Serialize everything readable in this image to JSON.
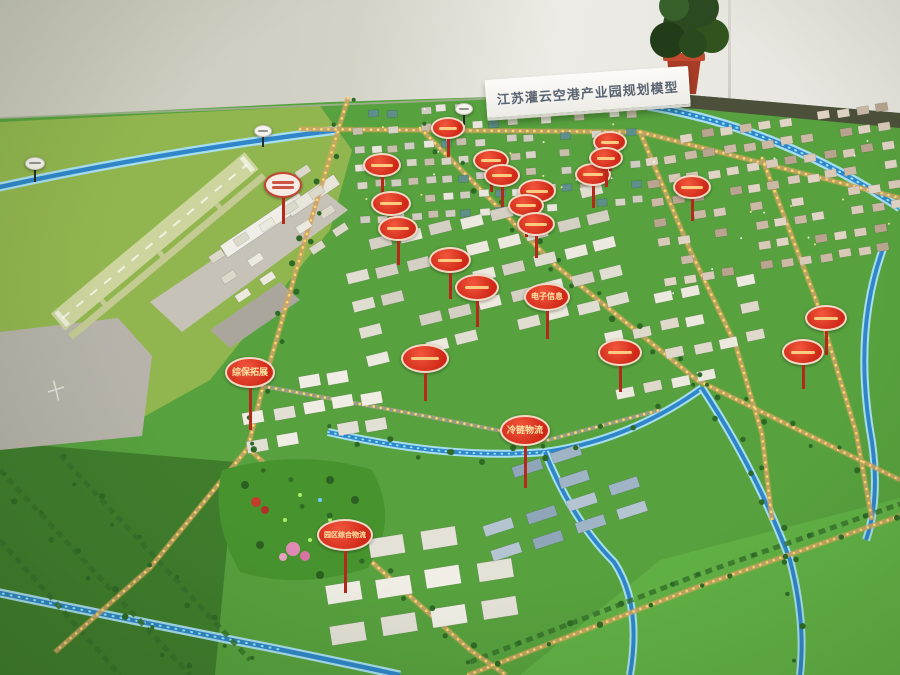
{
  "photo": {
    "title_board": {
      "text": "江苏灌云空港产业园规划模型"
    },
    "colors": {
      "sign_red": "#d02a18",
      "sign_text": "#ffe9a8",
      "road_lights": "#ffd76a",
      "river": "#2f86c8",
      "grass": "#58a13e",
      "wall": "#d9d7cd"
    },
    "signs": [
      {
        "x": 35,
        "y": 162,
        "w": 18,
        "h": 11,
        "pole": 12,
        "style": "white",
        "label": ""
      },
      {
        "x": 263,
        "y": 130,
        "w": 16,
        "h": 10,
        "pole": 10,
        "style": "white",
        "label": ""
      },
      {
        "x": 464,
        "y": 108,
        "w": 16,
        "h": 10,
        "pole": 10,
        "style": "white",
        "label": ""
      },
      {
        "x": 283,
        "y": 183,
        "w": 34,
        "h": 22,
        "pole": 26,
        "style": "light",
        "label": ""
      },
      {
        "x": 448,
        "y": 126,
        "w": 30,
        "h": 18,
        "pole": 18,
        "style": "red",
        "label": ""
      },
      {
        "x": 382,
        "y": 163,
        "w": 34,
        "h": 20,
        "pole": 22,
        "style": "red",
        "label": ""
      },
      {
        "x": 391,
        "y": 201,
        "w": 36,
        "h": 21,
        "pole": 24,
        "style": "red",
        "label": ""
      },
      {
        "x": 398,
        "y": 226,
        "w": 36,
        "h": 21,
        "pole": 24,
        "style": "red",
        "label": ""
      },
      {
        "x": 491,
        "y": 158,
        "w": 32,
        "h": 19,
        "pole": 20,
        "style": "red",
        "label": ""
      },
      {
        "x": 502,
        "y": 173,
        "w": 32,
        "h": 19,
        "pole": 20,
        "style": "red",
        "label": ""
      },
      {
        "x": 537,
        "y": 189,
        "w": 34,
        "h": 20,
        "pole": 22,
        "style": "red",
        "label": ""
      },
      {
        "x": 526,
        "y": 203,
        "w": 32,
        "h": 19,
        "pole": 20,
        "style": "red",
        "label": ""
      },
      {
        "x": 536,
        "y": 222,
        "w": 34,
        "h": 20,
        "pole": 22,
        "style": "red",
        "label": ""
      },
      {
        "x": 593,
        "y": 172,
        "w": 32,
        "h": 19,
        "pole": 22,
        "style": "red",
        "label": ""
      },
      {
        "x": 610,
        "y": 140,
        "w": 30,
        "h": 18,
        "pole": 18,
        "style": "red",
        "label": ""
      },
      {
        "x": 606,
        "y": 156,
        "w": 30,
        "h": 18,
        "pole": 18,
        "style": "red",
        "label": ""
      },
      {
        "x": 692,
        "y": 185,
        "w": 34,
        "h": 20,
        "pole": 22,
        "style": "red",
        "label": ""
      },
      {
        "x": 826,
        "y": 316,
        "w": 38,
        "h": 22,
        "pole": 24,
        "style": "red",
        "label": ""
      },
      {
        "x": 803,
        "y": 350,
        "w": 38,
        "h": 22,
        "pole": 24,
        "style": "red",
        "label": ""
      },
      {
        "x": 450,
        "y": 258,
        "w": 38,
        "h": 22,
        "pole": 26,
        "style": "red",
        "label": ""
      },
      {
        "x": 477,
        "y": 285,
        "w": 40,
        "h": 23,
        "pole": 26,
        "style": "red",
        "label": ""
      },
      {
        "x": 547,
        "y": 295,
        "w": 42,
        "h": 24,
        "pole": 28,
        "style": "red",
        "label": "电子信息"
      },
      {
        "x": 425,
        "y": 356,
        "w": 44,
        "h": 25,
        "pole": 28,
        "style": "red",
        "label": ""
      },
      {
        "x": 620,
        "y": 350,
        "w": 40,
        "h": 23,
        "pole": 26,
        "style": "red",
        "label": ""
      },
      {
        "x": 250,
        "y": 370,
        "w": 46,
        "h": 27,
        "pole": 42,
        "style": "red",
        "label": "综保拓展"
      },
      {
        "x": 525,
        "y": 428,
        "w": 46,
        "h": 27,
        "pole": 42,
        "style": "red",
        "label": "冷链物流"
      },
      {
        "x": 345,
        "y": 533,
        "w": 52,
        "h": 28,
        "pole": 42,
        "style": "red",
        "label": "园区综合物流"
      }
    ],
    "clusters": [
      {
        "x": 352,
        "y": 112,
        "w": 290,
        "h": 122,
        "rot": -4,
        "cols": 17,
        "rows": 7,
        "bw": 10,
        "bh": 7,
        "palette": [
          "#e9e6dd",
          "#d8d4c8",
          "#cfccc2",
          "#5e8f8b",
          "#c9beac"
        ],
        "lights": 26,
        "seed": 11
      },
      {
        "x": 642,
        "y": 140,
        "w": 255,
        "h": 160,
        "rot": -9,
        "cols": 13,
        "rows": 8,
        "bw": 12,
        "bh": 8,
        "palette": [
          "#d9c9b8",
          "#cbb9a6",
          "#e0d4c4",
          "#b9a58f"
        ],
        "lights": 14,
        "seed": 22
      },
      {
        "x": 338,
        "y": 248,
        "w": 280,
        "h": 140,
        "rot": -14,
        "cols": 9,
        "rows": 5,
        "bw": 22,
        "bh": 11,
        "palette": [
          "#eceadf",
          "#e0ddd1",
          "#d4d0c3"
        ],
        "lights": 0,
        "seed": 33
      },
      {
        "x": 238,
        "y": 388,
        "w": 150,
        "h": 80,
        "rot": -10,
        "cols": 5,
        "rows": 3,
        "bw": 21,
        "bh": 12,
        "palette": [
          "#efede4",
          "#e2dfd4"
        ],
        "lights": 0,
        "seed": 44
      },
      {
        "x": 598,
        "y": 306,
        "w": 168,
        "h": 115,
        "rot": -12,
        "cols": 6,
        "rows": 4,
        "bw": 18,
        "bh": 10,
        "palette": [
          "#eceade",
          "#ded9cb"
        ],
        "lights": 0,
        "seed": 55
      },
      {
        "x": 318,
        "y": 548,
        "w": 205,
        "h": 118,
        "rot": -9,
        "cols": 4,
        "rows": 3,
        "bw": 35,
        "bh": 19,
        "palette": [
          "#f0eee5",
          "#e4e1d7"
        ],
        "lights": 0,
        "seed": 66
      },
      {
        "x": 468,
        "y": 480,
        "w": 175,
        "h": 100,
        "rot": -18,
        "cols": 4,
        "rows": 4,
        "bw": 30,
        "bh": 11,
        "palette": [
          "#9fb4c4",
          "#8ea6b8",
          "#b4c4d0"
        ],
        "lights": 0,
        "seed": 77
      },
      {
        "x": 196,
        "y": 238,
        "w": 148,
        "h": 92,
        "rot": -33,
        "cols": 5,
        "rows": 4,
        "bw": 15,
        "bh": 8,
        "palette": [
          "#eceade",
          "#dcd8ca"
        ],
        "lights": 0,
        "seed": 88
      }
    ],
    "tree_lines": [
      [
        [
          348,
          98
        ],
        [
          305,
          240
        ],
        [
          262,
          390
        ],
        [
          248,
          448
        ]
      ],
      [
        [
          248,
          448
        ],
        [
          345,
          538
        ],
        [
          470,
          650
        ]
      ],
      [
        [
          420,
          128
        ],
        [
          555,
          265
        ],
        [
          697,
          380
        ],
        [
          860,
          465
        ]
      ],
      [
        [
          328,
          432
        ],
        [
          450,
          458
        ],
        [
          545,
          452
        ],
        [
          660,
          412
        ]
      ],
      [
        [
          702,
          388
        ],
        [
          756,
          470
        ],
        [
          790,
          560
        ],
        [
          800,
          660
        ]
      ],
      [
        [
          470,
          668
        ],
        [
          700,
          580
        ],
        [
          895,
          512
        ]
      ],
      [
        [
          0,
          478
        ],
        [
          185,
          670
        ]
      ],
      [
        [
          60,
          460
        ],
        [
          248,
          662
        ]
      ]
    ]
  }
}
